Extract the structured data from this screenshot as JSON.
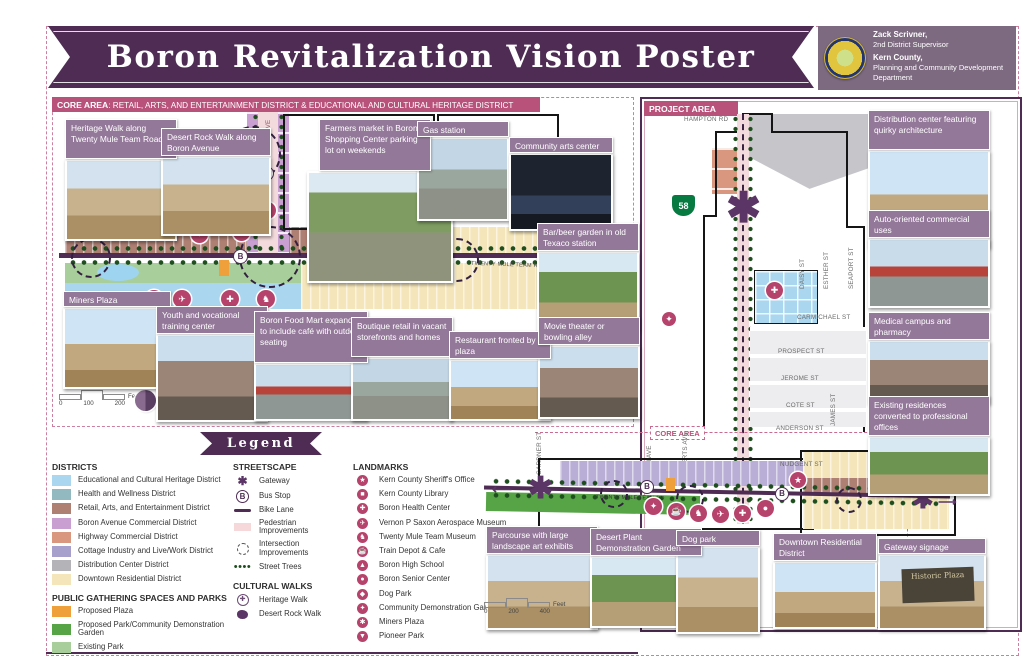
{
  "title": "Boron Revitalization Vision Poster",
  "credits": {
    "line1_bold": "Zack Scrivner,",
    "line1_rest": "2nd District Supervisor",
    "line2_bold": "Kern County,",
    "line2_rest": "Planning and Community Development Department"
  },
  "core_area": {
    "header_bold": "CORE AREA",
    "header_rest": ": RETAIL, ARTS, AND ENTERTAINMENT DISTRICT & EDUCATIONAL AND CULTURAL HERITAGE DISTRICT",
    "road_label": "TWENTY MULE TEAM RD",
    "avenue_label": "BORON AVE",
    "scale": {
      "tick0": "0",
      "tick1": "100",
      "tick2": "200",
      "unit": "Feet"
    },
    "callouts": [
      {
        "label": "Heritage Walk along Twenty Mule Team Road"
      },
      {
        "label": "Desert Rock Walk along Boron Avenue"
      },
      {
        "label": "Farmers market in Boron Shopping Center parking lot on weekends"
      },
      {
        "label": "Gas station"
      },
      {
        "label": "Community arts center"
      },
      {
        "label": "Bar/beer garden in old Texaco station"
      },
      {
        "label": "Miners Plaza"
      },
      {
        "label": "Youth and vocational training center"
      },
      {
        "label": "Boron Food Mart expanded to include café with outdoor seating"
      },
      {
        "label": "Boutique retail in vacant storefronts and homes"
      },
      {
        "label": "Restaurant fronted by a plaza"
      },
      {
        "label": "Movie theater or bowling alley"
      }
    ]
  },
  "project_area": {
    "header": "PROJECT AREA",
    "core_area_label": "CORE AREA",
    "highway_shield": "58",
    "road_label": "TWENTY MULE TEAM RD",
    "gateway_sign_text": "Historic Plaza",
    "streets": {
      "hampton": "HAMPTON RD",
      "carmichael": "CARMICHAEL ST",
      "prospect": "PROSPECT ST",
      "jerome": "JEROME ST",
      "cote": "COTE ST",
      "anderson": "ANDERSON ST",
      "nudgent": "NUDGENT ST",
      "daisy": "DAISY ST",
      "esther": "ESTHER ST",
      "seaport": "SEAPORT ST",
      "james": "JAMES ST",
      "gardner": "GARDNER ST",
      "kern": "KERN AVE",
      "roberts": "ROBERTS AVE"
    },
    "scale": {
      "tick0": "0",
      "tick1": "200",
      "tick2": "400",
      "unit": "Feet"
    },
    "callouts_right": [
      {
        "label": "Distribution center featuring quirky architecture"
      },
      {
        "label": "Auto-oriented commercial uses"
      },
      {
        "label": "Medical campus and pharmacy"
      },
      {
        "label": "Existing residences converted to professional offices"
      }
    ],
    "callouts_bottom": [
      {
        "label": "Parcourse with large landscape art exhibits"
      },
      {
        "label": "Desert Plant Demonstration Garden"
      },
      {
        "label": "Dog park"
      },
      {
        "label": "Downtown Residential District"
      },
      {
        "label": "Gateway signage"
      }
    ]
  },
  "legend": {
    "title": "Legend",
    "districts": {
      "heading": "DISTRICTS",
      "items": [
        {
          "label": "Educational and Cultural Heritage District",
          "color": "#aad7ef"
        },
        {
          "label": "Health and Wellness District",
          "color": "#92b8c0"
        },
        {
          "label": "Retail, Arts, and Entertainment District",
          "color": "#ae7f73"
        },
        {
          "label": "Boron Avenue Commercial District",
          "color": "#c99ed0"
        },
        {
          "label": "Highway Commercial District",
          "color": "#d9977f"
        },
        {
          "label": "Cottage Industry and Live/Work District",
          "color": "#a8a0cc"
        },
        {
          "label": "Distribution Center District",
          "color": "#b4b4b8"
        },
        {
          "label": "Downtown Residential District",
          "color": "#f4e6ba"
        }
      ]
    },
    "parks": {
      "heading": "PUBLIC GATHERING SPACES AND PARKS",
      "items": [
        {
          "label": "Proposed Plaza",
          "color": "#f0a03a"
        },
        {
          "label": "Proposed Park/Community Demonstration Garden",
          "color": "#57a447"
        },
        {
          "label": "Existing Park",
          "color": "#a8ce9b"
        }
      ]
    },
    "streetscape": {
      "heading": "STREETSCAPE",
      "items": [
        {
          "label": "Gateway",
          "glyph": "✱"
        },
        {
          "label": "Bus Stop",
          "glyph": "B"
        },
        {
          "label": "Bike Lane",
          "color": "#4e2c54"
        },
        {
          "label": "Pedestrian Improvements",
          "color": "#f6d8da"
        },
        {
          "label": "Intersection Improvements"
        },
        {
          "label": "Street Trees",
          "glyph": "••••",
          "color": "#1e4e1e"
        }
      ]
    },
    "cultural_walks": {
      "heading": "CULTURAL WALKS",
      "items": [
        {
          "label": "Heritage Walk"
        },
        {
          "label": "Desert Rock Walk"
        }
      ]
    },
    "landmarks": {
      "heading": "LANDMARKS",
      "items": [
        {
          "label": "Kern County Sheriff's Office",
          "glyph": "★"
        },
        {
          "label": "Kern County Library",
          "glyph": "■"
        },
        {
          "label": "Boron Health Center",
          "glyph": "✚"
        },
        {
          "label": "Vernon P Saxon Aerospace Museum",
          "glyph": "✈"
        },
        {
          "label": "Twenty Mule Team Museum",
          "glyph": "♞"
        },
        {
          "label": "Train Depot & Cafe",
          "glyph": "☕"
        },
        {
          "label": "Boron High School",
          "glyph": "▲"
        },
        {
          "label": "Boron Senior Center",
          "glyph": "●"
        },
        {
          "label": "Dog Park",
          "glyph": "◆"
        },
        {
          "label": "Community Demonstration Garden",
          "glyph": "✦"
        },
        {
          "label": "Miners Plaza",
          "glyph": "✱"
        },
        {
          "label": "Pioneer Park",
          "glyph": "▼"
        }
      ]
    }
  },
  "colors": {
    "banner": "#4e2c54",
    "header_bar": "#b8527a",
    "caption": "#94789a",
    "road": "#4e2c54",
    "landmark_icon": "#b6436b"
  }
}
